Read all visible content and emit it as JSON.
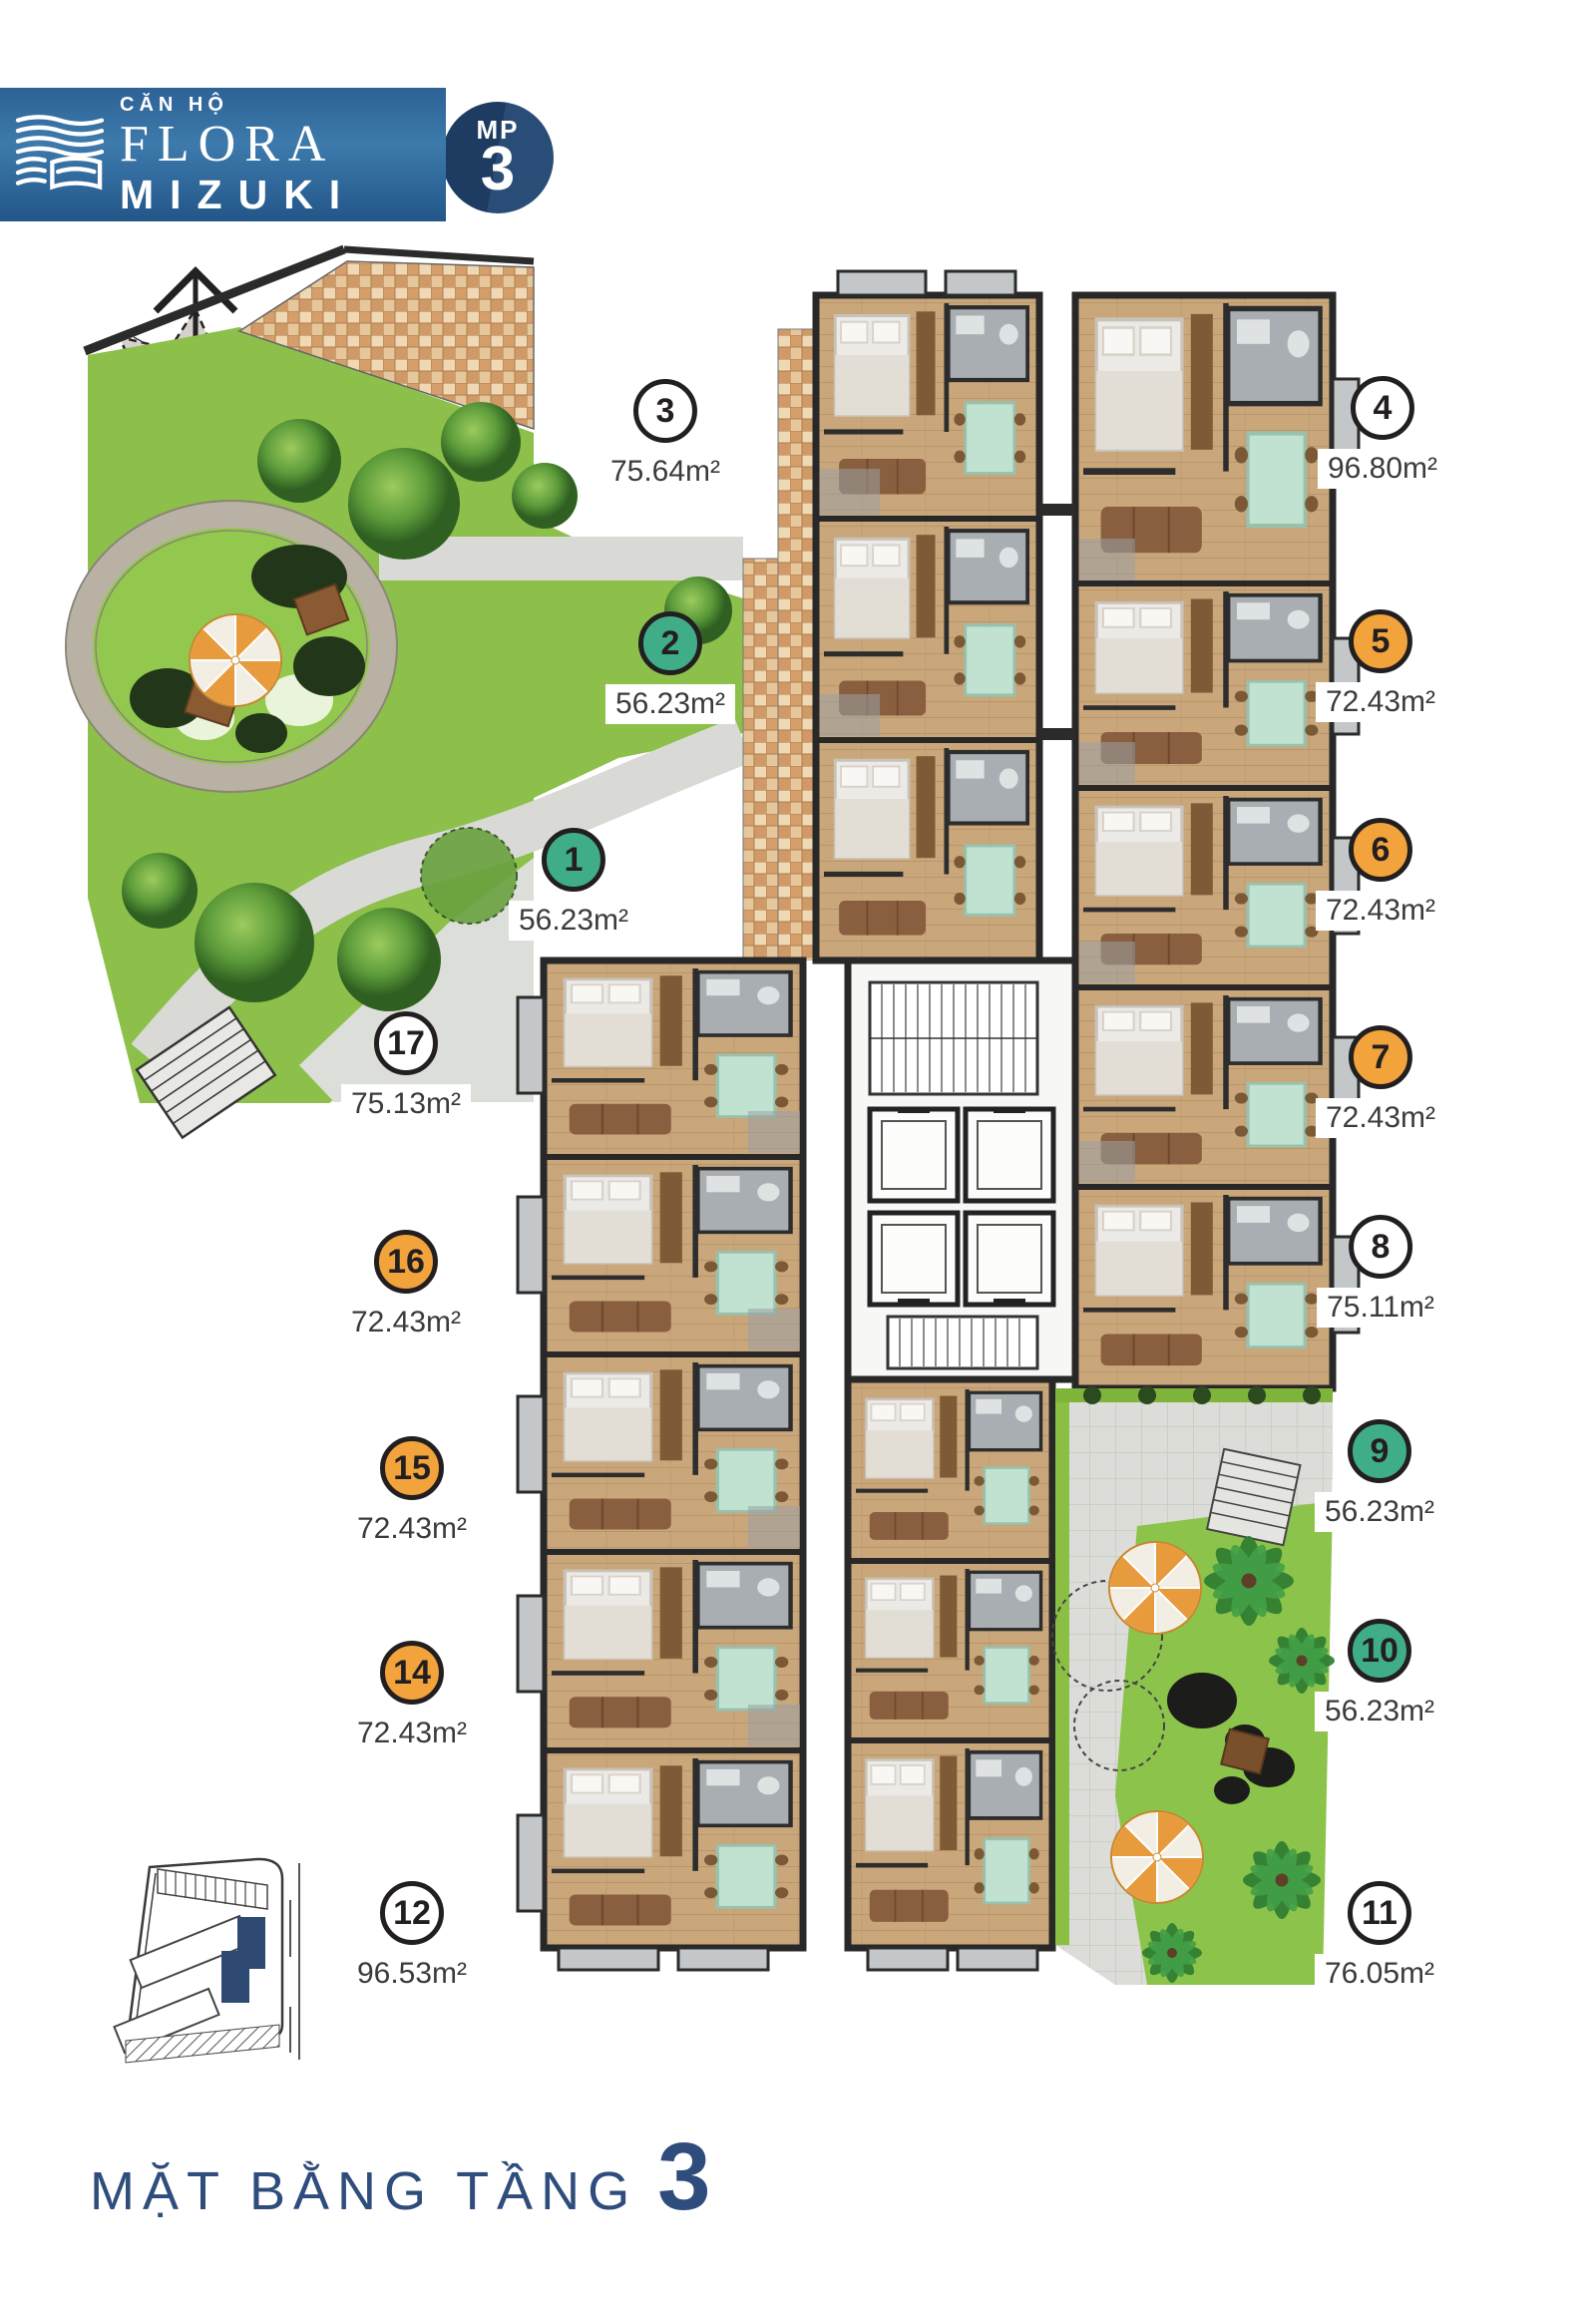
{
  "logo": {
    "category": "CĂN HỘ",
    "brand_serif": "FLORA",
    "brand_spaced": "MIZUKI",
    "corner_badge_label": "MP",
    "corner_badge_number": "3"
  },
  "floor_title": {
    "label": "MẶT BẰNG TẦNG",
    "number": "3"
  },
  "legend_colors": {
    "badge_green": "#3fae88",
    "badge_orange": "#f2a33c",
    "badge_white": "#ffffff",
    "badge_outline": "#231f20",
    "brand_navy": "#2f4d7c"
  },
  "units": [
    {
      "number": "1",
      "area": "56.23m²",
      "color": "green"
    },
    {
      "number": "2",
      "area": "56.23m²",
      "color": "green"
    },
    {
      "number": "3",
      "area": "75.64m²",
      "color": "white"
    },
    {
      "number": "4",
      "area": "96.80m²",
      "color": "white"
    },
    {
      "number": "5",
      "area": "72.43m²",
      "color": "orange"
    },
    {
      "number": "6",
      "area": "72.43m²",
      "color": "orange"
    },
    {
      "number": "7",
      "area": "72.43m²",
      "color": "orange"
    },
    {
      "number": "8",
      "area": "75.11m²",
      "color": "white"
    },
    {
      "number": "9",
      "area": "56.23m²",
      "color": "green"
    },
    {
      "number": "10",
      "area": "56.23m²",
      "color": "green"
    },
    {
      "number": "11",
      "area": "76.05m²",
      "color": "white"
    },
    {
      "number": "12",
      "area": "96.53m²",
      "color": "white"
    },
    {
      "number": "14",
      "area": "72.43m²",
      "color": "orange"
    },
    {
      "number": "15",
      "area": "72.43m²",
      "color": "orange"
    },
    {
      "number": "16",
      "area": "72.43m²",
      "color": "orange"
    },
    {
      "number": "17",
      "area": "75.13m²",
      "color": "white"
    }
  ]
}
